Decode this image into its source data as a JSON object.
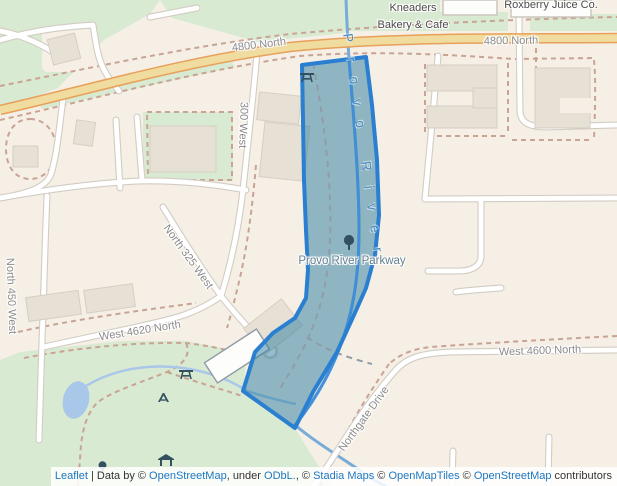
{
  "labels": [
    {
      "id": "kneaders-line1",
      "text": "Kneaders"
    },
    {
      "id": "kneaders-line2",
      "text": "Bakery & Cafe"
    },
    {
      "id": "roxberry",
      "text": "Roxberry Juice Co."
    },
    {
      "id": "n4800-west",
      "text": "4800 North"
    },
    {
      "id": "n4800-east",
      "text": "4800 North"
    },
    {
      "id": "w300",
      "text": "300 West"
    },
    {
      "id": "n325w",
      "text": "North 325 West"
    },
    {
      "id": "n450w",
      "text": "North 450 West"
    },
    {
      "id": "w4620n",
      "text": "West 4620 North"
    },
    {
      "id": "w4600n",
      "text": "West 4600 North"
    },
    {
      "id": "northgate",
      "text": "Northgate Drive"
    },
    {
      "id": "parkway",
      "text": "Provo River Parkway"
    },
    {
      "id": "river",
      "text": "Provo River"
    }
  ],
  "icons": [
    "park-tree-icon",
    "picnic-table-icon",
    "picnic-table-icon",
    "playground-icon",
    "picnic-shelter-icon",
    "small-tree-icon"
  ],
  "attribution": {
    "leaflet": "Leaflet",
    "separator": " | ",
    "data_by": "Data by ",
    "c1": "© ",
    "osm": "OpenStreetMap",
    "under": ", under ",
    "odbl": "ODbL.",
    "c2": ", © ",
    "stadia": "Stadia Maps",
    "c3": " © ",
    "openmaptiles": "OpenMapTiles",
    "c4": " © ",
    "osm2": "OpenStreetMap",
    "contributors": " contributors"
  },
  "colors": {
    "land": "#f5efe6",
    "park_green": "#d9ead2",
    "water": "#a9c7e8",
    "river_line": "#3f8ed8",
    "primary_road_fill": "#f0dc9f",
    "primary_road_casing": "#e8a05a",
    "path_dashed": "#c9a393",
    "building": "#e6e0d5",
    "selection_fill": "#297b9e",
    "selection_border": "#2a7fd0",
    "link_blue": "#1f77c0",
    "street_label": "#8b8b8b",
    "poi_label": "#4c4c4c"
  }
}
